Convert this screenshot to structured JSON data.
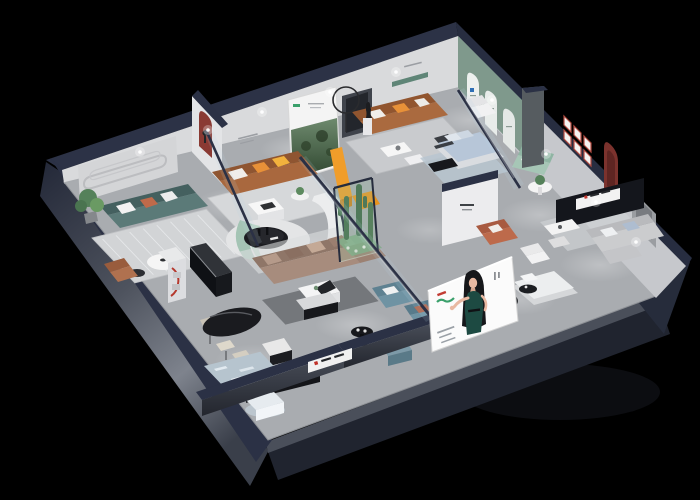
{
  "scene": {
    "name": "isometric-furniture-showroom-cutaway-render",
    "background_color": "#000000",
    "view": "3d-isometric-top-down-cutaway"
  },
  "palette": {
    "outer_wall_navy": "#2b3145",
    "outer_wall_dark": "#1a1f2d",
    "wall_face_light": "#d9dadc",
    "wall_face_shaded": "#c6c8cc",
    "floor_gray": "#a9acb0",
    "accent_green_wall": "#7f998c",
    "accent_red_arch": "#8a3a33",
    "sofa_teal": "#5b7a78",
    "sofa_caramel": "#a9683e",
    "sofa_brown_leather": "#8f5531",
    "sofa_taupe": "#a78c7d",
    "sofa_steel_blue": "#6f93a3",
    "sofa_mint": "#a6c6b6",
    "sofa_gray": "#c9cacd",
    "accent_orange_pillow": "#e89138",
    "accent_yellow_bench": "#f09d2a",
    "bed_blue": "#b7c6d8",
    "cactus_green": "#41694a",
    "terrarium_tint": "#7da883",
    "poster_dress_green": "#1d4a42",
    "logo_green": "#3aa06b",
    "logo_red": "#c23b33",
    "glass_tint": "rgba(185,210,230,0.14)"
  },
  "rooms": [
    {
      "id": "room-teal-lounge",
      "label": "teal-sofa-lounge-with-groove-wall"
    },
    {
      "id": "room-leather-lounge",
      "label": "brown-leather-sofa-room-with-forest-banner"
    },
    {
      "id": "room-caramel-lounge",
      "label": "caramel-sofa-room-with-ring-lamp-and-sculpture"
    },
    {
      "id": "room-green-arch-bedroom",
      "label": "sage-arch-wall-blue-bed-showcase"
    },
    {
      "id": "room-right-gray-suite",
      "label": "gray-sofa-suite-with-red-arch-and-tv-wall"
    },
    {
      "id": "room-center-lounge",
      "label": "taupe-sectional-lounge-with-cactus-terrarium"
    },
    {
      "id": "room-dining",
      "label": "black-oval-dining-set"
    },
    {
      "id": "room-blue-lounge",
      "label": "steel-blue-leather-lounge"
    },
    {
      "id": "room-front-bedroom",
      "label": "white-bed-with-black-round-rug"
    }
  ],
  "signage": {
    "poster_woman": {
      "name": "fashion-woman-illustration-poster",
      "elements": [
        "green-script-logo",
        "red-brand-mark",
        "vertical-caption",
        "footer-text-lines"
      ]
    },
    "forest_banner": {
      "name": "forest-photo-rollup-banner",
      "elements": [
        "green-logo-mark",
        "caption-lines"
      ]
    },
    "tv_wall_sign": {
      "name": "brand-strip-sign-red-accent"
    },
    "front_wall_sign": {
      "name": "brand-strip-sign-front"
    },
    "red_frame_grid": {
      "name": "six-red-framed-prints"
    },
    "arch_logos": {
      "name": "blue-m-logo-with-captions"
    }
  }
}
